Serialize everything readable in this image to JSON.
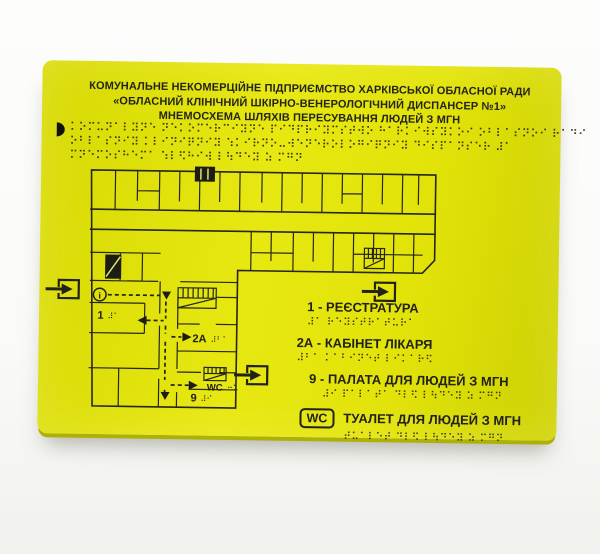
{
  "colors": {
    "plate_yellow": "#e3e40a",
    "plate_edge": "#aeb103",
    "ink": "#23231a",
    "photo_background": "#fafaf8"
  },
  "header": {
    "line1": "КОМУНАЛЬНЕ НЕКОМЕРЦІЙНЕ ПІДПРИЄМСТВО ХАРКІВСЬКОЇ ОБЛАСНОЇ РАДИ",
    "line2": "«ОБЛАСНИЙ КЛІНІЧНИЙ ШКІРНО-ВЕНЕРОЛОГІЧНИЙ ДИСПАНСЕР №1»",
    "line3": "МНЕМОСХЕМА ШЛЯХІВ ПЕРЕСУВАННЯ ЛЮДЕЙ З МГН"
  },
  "braille_block": {
    "lines": [
      "⠅⠕⠍⠥⠝⠁⠇⠽⠝⠑ ⠝⠑⠅⠕⠍⠑⠗⠉⠊⠽⠝⠑ ⠏⠊⠙⠏⠗⠊⠽⠍⠎⠞⠺⠕ ⠓⠁⠗⠅⠊⠺⠎⠽⠅⠕⠊ ⠕⠃⠇⠁⠎⠝⠕⠊ ⠗⠁⠙⠊",
      "⠕⠃⠇⠁⠎⠝⠊⠽ ⠅⠇⠊⠝⠊⠟⠝⠊⠽ ⠱⠅⠊⠗⠝⠕⠤⠺⠑⠝⠑⠗⠕⠇⠕⠛⠊⠟⠝⠊⠽ ⠙⠊⠎⠏⠁⠝⠎⠑⠗ ⠼⠁",
      "⠍⠝⠑⠍⠕⠎⠓⠑⠍⠁ ⠱⠇⠫⠓⠊⠺ ⠇⠳⠙⠑⠽ ⠵ ⠍⠛⠝"
    ]
  },
  "plan": {
    "labels": {
      "room1": {
        "text": "1",
        "braille": "⠼⠁"
      },
      "room2a": {
        "text": "2А",
        "braille": "⠼⠃⠁"
      },
      "wc": {
        "text": "WC",
        "braille": "⠒⠥"
      },
      "room9": {
        "text": "9",
        "braille": "⠼⠊"
      },
      "info": {
        "text": "i"
      }
    },
    "icons": {
      "exit": "exit-arrow",
      "info": "info-point",
      "stairs": "stairs",
      "elevator": "elevator",
      "braille_start_marker": "half-circle"
    }
  },
  "legend": {
    "items": [
      {
        "key": "1",
        "sep": " - ",
        "label": "РЕЄСТРАТУРА",
        "braille": "⠼⠁ ⠗⠑⠽⠎⠞⠗⠁⠞⠥⠗⠁"
      },
      {
        "key": "2А",
        "sep": " - ",
        "label": "КАБІНЕТ ЛІКАРЯ",
        "braille": "⠼⠃⠁ ⠅⠁⠃⠊⠝⠑⠞ ⠇⠊⠅⠁⠗⠫"
      },
      {
        "key": "9",
        "sep": " - ",
        "label": "ПАЛАТА ДЛЯ ЛЮДЕЙ З МГН",
        "braille": "⠼⠊ ⠏⠁⠇⠁⠞⠁ ⠙⠇⠫ ⠇⠳⠙⠑⠽ ⠵ ⠍⠛⠝"
      },
      {
        "key": "WC",
        "sep": "",
        "label": "ТУАЛЕТ ДЛЯ ЛЮДЕЙ З МГН",
        "braille": "⠞⠥⠁⠇⠑⠞ ⠙⠇⠫ ⠇⠳⠙⠑⠽ ⠵ ⠍⠛⠝"
      }
    ]
  }
}
